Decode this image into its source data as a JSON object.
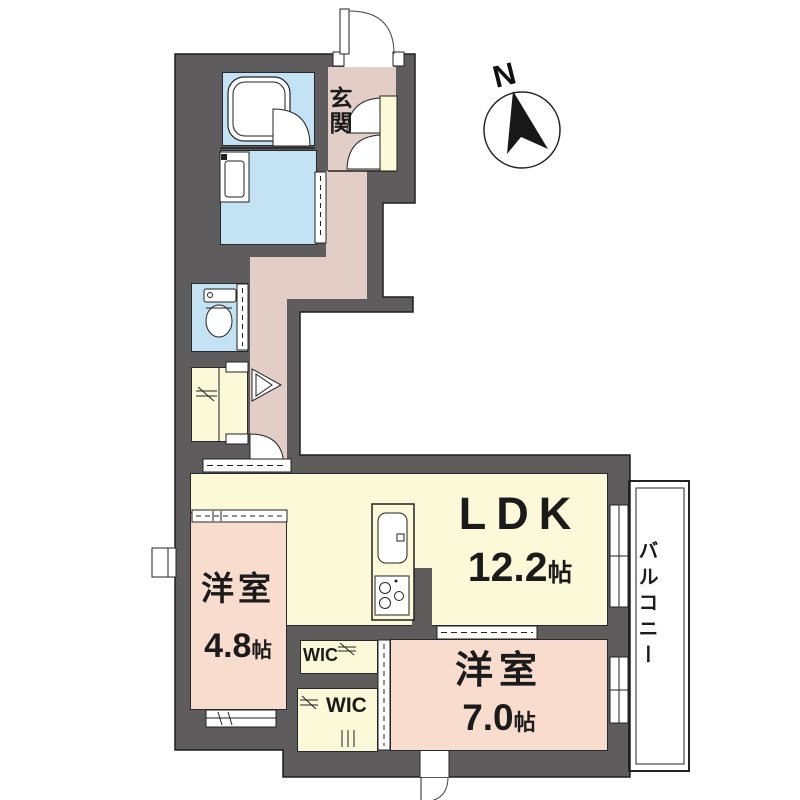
{
  "plan": {
    "compass": {
      "label": "N"
    },
    "entrance": {
      "label": "玄関"
    },
    "ldk": {
      "label": "LDK",
      "size_num": "12.2",
      "size_unit": "帖"
    },
    "bedroom_small": {
      "label": "洋室",
      "size_num": "4.8",
      "size_unit": "帖"
    },
    "bedroom_large": {
      "label": "洋室",
      "size_num": "7.0",
      "size_unit": "帖"
    },
    "wic_upper": {
      "label": "WIC"
    },
    "wic_lower": {
      "label": "WIC"
    },
    "balcony": {
      "label": "バルコニー"
    }
  },
  "colors": {
    "wall": "#5e5c5c",
    "wet_area": "#c3e3f5",
    "hallway": "#e2cdc7",
    "western_room": "#f8ddcf",
    "ldk_and_closets": "#fbf9d7",
    "outline": "#1f1f1f",
    "background": "#ffffff"
  }
}
